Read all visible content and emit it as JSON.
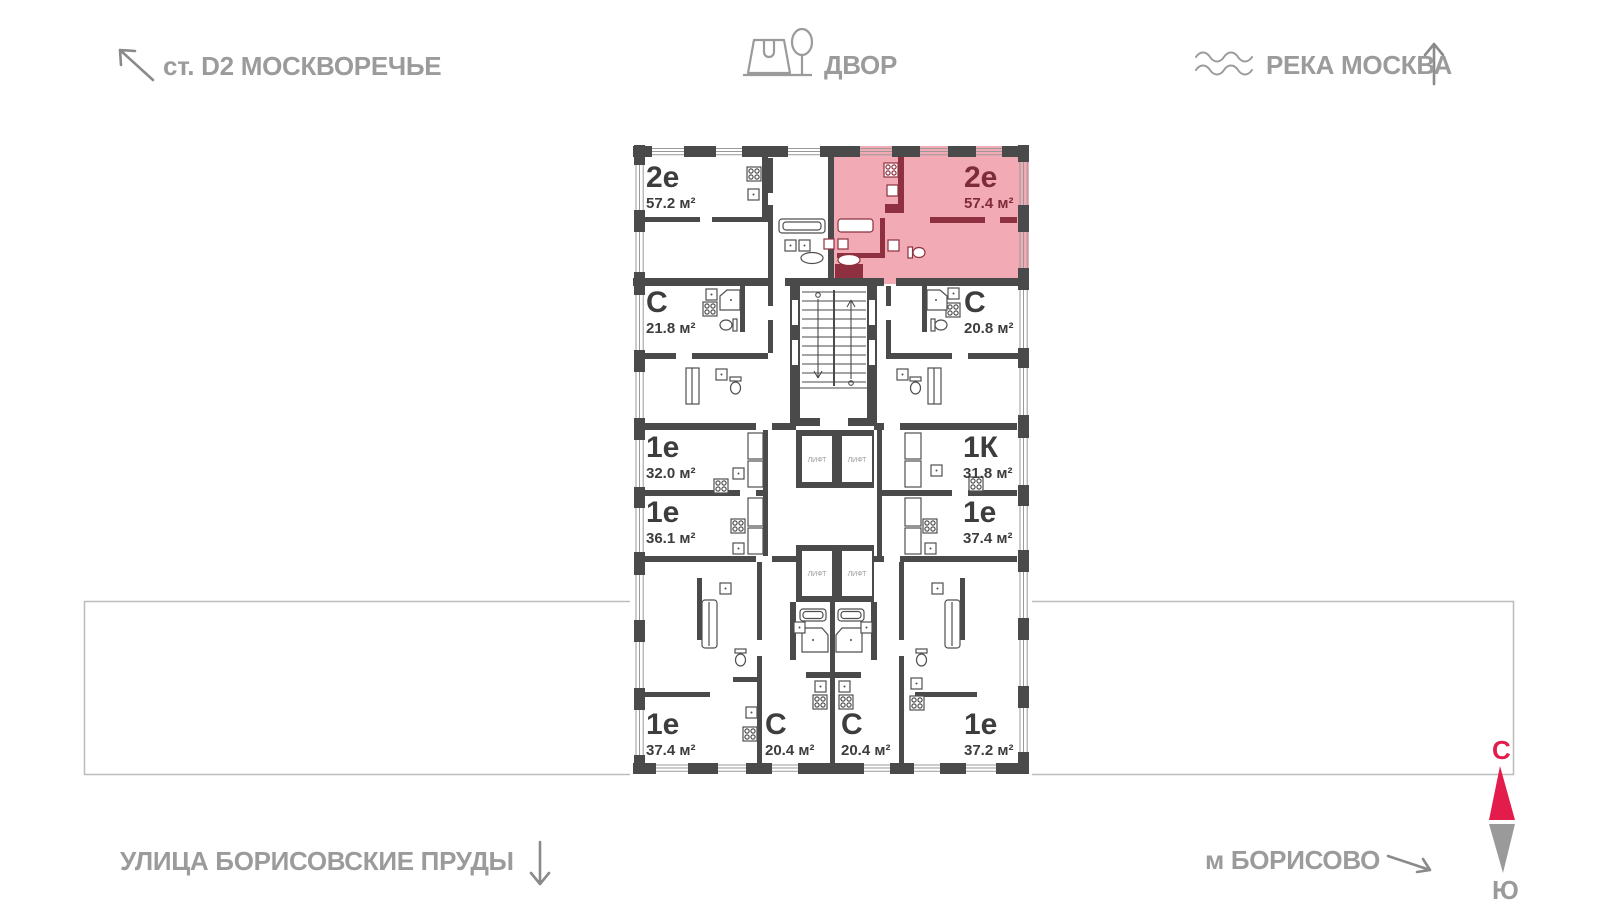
{
  "surroundings": {
    "station": {
      "label": "ст. D2 МОСКВОРЕЧЬЕ"
    },
    "yard": {
      "label": "ДВОР"
    },
    "river": {
      "label": "РЕКА МОСКВА"
    },
    "street": {
      "label": "УЛИЦА БОРИСОВСКИЕ ПРУДЫ"
    },
    "metro": {
      "label": "м БОРИСОВО"
    }
  },
  "compass": {
    "north": "С",
    "south": "Ю"
  },
  "plan": {
    "lift_label": "ЛИФТ",
    "highlighted_apartment": {
      "type": "2е",
      "area": "57.4 м²"
    },
    "apartments": [
      {
        "type": "2е",
        "area": "57.2 м²",
        "highlighted": false
      },
      {
        "type": "2е",
        "area": "57.4 м²",
        "highlighted": true
      },
      {
        "type": "С",
        "area": "21.8 м²",
        "highlighted": false
      },
      {
        "type": "С",
        "area": "20.8 м²",
        "highlighted": false
      },
      {
        "type": "1е",
        "area": "32.0 м²",
        "highlighted": false
      },
      {
        "type": "1К",
        "area": "31.8 м²",
        "highlighted": false
      },
      {
        "type": "1е",
        "area": "36.1 м²",
        "highlighted": false
      },
      {
        "type": "1е",
        "area": "37.4 м²",
        "highlighted": false
      },
      {
        "type": "1е",
        "area": "37.4 м²",
        "highlighted": false
      },
      {
        "type": "С",
        "area": "20.4 м²",
        "highlighted": false
      },
      {
        "type": "С",
        "area": "20.4 м²",
        "highlighted": false
      },
      {
        "type": "1е",
        "area": "37.2 м²",
        "highlighted": false
      }
    ]
  },
  "colors": {
    "wall": "#4a4a4a",
    "highlight_fill": "#f2abb4",
    "highlight_wall": "#8e3040",
    "map_label": "#9b9b9b",
    "compass_north": "#e31c4c",
    "compass_south": "#9a9a9a"
  }
}
